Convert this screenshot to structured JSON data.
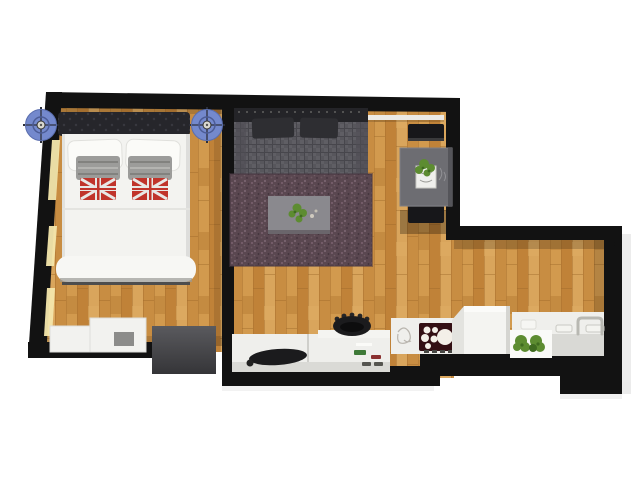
{
  "scene": {
    "kind": "floor-plan-render",
    "description": "3D top-down floor plan of a studio apartment with bedroom, living room, dining nook and kitchen",
    "background": "#ffffff"
  },
  "colors": {
    "background": "#ffffff",
    "wall": "#121212",
    "wall_shadow": "#d9d9d9",
    "wood_base": "#cf9549",
    "wood_light": "#dca75e",
    "wood_mid": "#c98e41",
    "wood_dark": "#bd7f35",
    "window_glow": "#f5e7ac",
    "headboard": "#26262b",
    "headboard_dot": "#3c3c44",
    "bed_white": "#f3f3f0",
    "pillow_white": "#fbfbf8",
    "cushion_gray": "#9c9c9a",
    "cushion_red": "#c0342b",
    "cushion_stripe": "#e8e8e6",
    "bolster_white": "#f7f7f4",
    "fan_blue": "#7489cd",
    "fan_dark": "#2c2f3a",
    "fan_hub": "#d9d8cf",
    "dresser_white": "#f2f2ef",
    "dresser_gray": "#8c8c8a",
    "door_panel_light": "#5a5a5e",
    "door_panel_dark": "#353538",
    "sofa_back": "#242428",
    "sofa_tweed": "#57565c",
    "sofa_tweed_light": "#5f5e64",
    "sofa_cushion": "#2e2e32",
    "rug": "#5a4750",
    "rug_speckle_light": "#86707a",
    "rug_speckle_dark": "#463640",
    "coffee_table": "#8a898e",
    "dining_table": "#6d6d72",
    "chair": "#17171a",
    "shelf": "#eceae5",
    "counter_white": "#efefec",
    "counter_front": "#d9d9d5",
    "hob": "#330f14",
    "burner": "#f3efe8",
    "plant_green": "#5d8c31",
    "plant_dark": "#3f6b20",
    "pot_black": "#1b1b1d",
    "accent_green": "#3f7a38",
    "accent_red": "#8a3030",
    "sketch": "#b9b5ae",
    "faucet": "#b8b8b2"
  },
  "rooms": [
    {
      "name": "bedroom",
      "items": [
        "tufted-headboard",
        "double-bed",
        "white-pillows",
        "gray-cushions",
        "union-jack-cushions",
        "bolster",
        "ceiling-fan-left",
        "ceiling-fan-right",
        "window-strips",
        "dresser-small",
        "dresser-large",
        "dark-door-panel"
      ]
    },
    {
      "name": "living-room",
      "items": [
        "tweed-sofa",
        "sofa-cushions",
        "area-rug",
        "coffee-table",
        "coffee-table-plant",
        "media-counter",
        "black-basin",
        "black-pot",
        "accent-items"
      ]
    },
    {
      "name": "dining-nook",
      "items": [
        "wall-shelf",
        "dining-table",
        "table-plant",
        "chair-north",
        "chair-south"
      ]
    },
    {
      "name": "kitchen",
      "items": [
        "cooktop-unit",
        "hob-burners",
        "fridge-cube",
        "kitchen-counter",
        "herb-plants",
        "sink-basins",
        "faucet"
      ]
    }
  ]
}
